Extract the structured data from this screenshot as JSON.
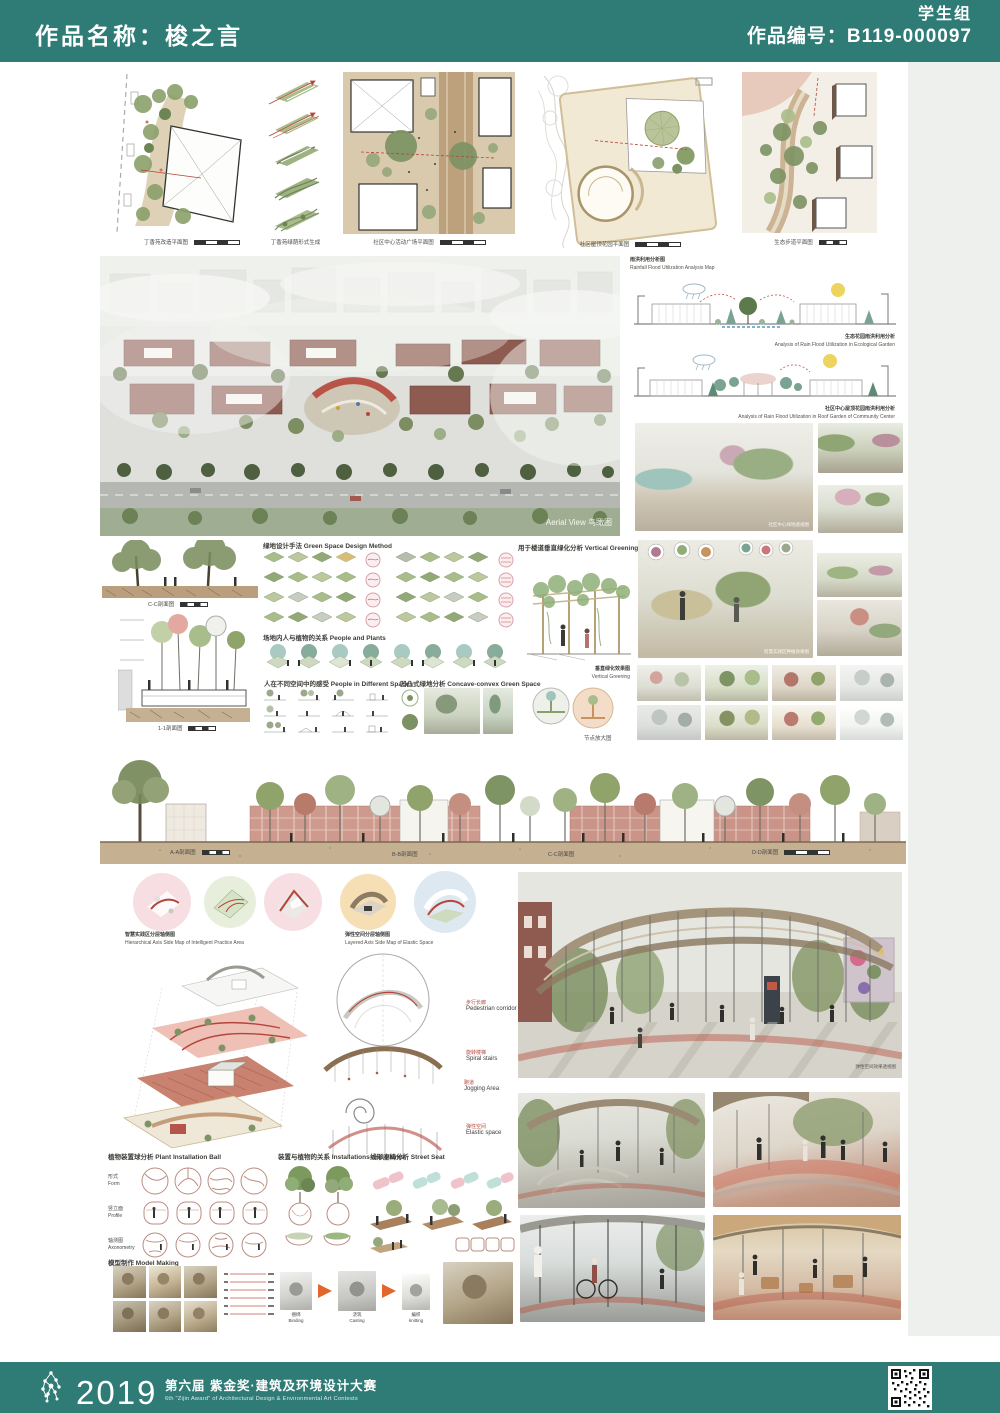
{
  "colors": {
    "teal": "#2f7b76",
    "accent_red": "#b5443a"
  },
  "header": {
    "work_name": "作品名称：梭之言",
    "group": "学生组",
    "work_code": "作品编号：B119-000097"
  },
  "top_row": {
    "captions": [
      "丁香苑改造平面图",
      "丁香苑绿荫形式生成",
      "社区中心活动广场平面图",
      "社区屋顶花园平面图",
      "生态步道平面图"
    ]
  },
  "aerial": {
    "caption": "Aerial View 鸟瞰图"
  },
  "rain": {
    "title_cn": "雨洪利用分析图",
    "title_en": "Rainfall Flood Utilization Analysis Map",
    "items": [
      {
        "cn": "生态花园雨洪利用分析",
        "en": "Analysis of Rain Flood Utilization in Ecological Garden"
      },
      {
        "cn": "社区中心屋顶花园雨洪利用分析",
        "en": "Analysis of Rain Flood Utilization in Roof Garden of Community Center"
      }
    ]
  },
  "renders": {
    "park_caption": "社区中心绿地透视图",
    "garden_caption": "智慧实践区种植效果图"
  },
  "green_method": {
    "title": "绿地设计手法 Green Space Design Method",
    "people_plants": "场地内人与植物的关系 People and Plants",
    "people_spaces": "人在不同空间中的感受 People in Different Spaces",
    "concave": "凹凸式绿地分析 Concave-convex Green Space",
    "vertical_title": "用于楼道垂直绿化分析 Vertical Greening in Tube Apartment",
    "vertical_caption_cn": "垂直绿化效果图",
    "vertical_caption_en": "Vertical Greening",
    "detail_caption": "节点放大图",
    "section_cc": "C-C剖面图",
    "section_11": "1-1剖面图"
  },
  "street": {
    "labels": [
      "A-A剖面图",
      "B-B剖面图",
      "C-C剖面图",
      "D-D剖面图"
    ]
  },
  "elastic": {
    "left_title_cn": "智慧实践区分层轴侧图",
    "left_title_en": "Hierarchical Axis Side Map of Intelligent Practice Area",
    "right_title_cn": "弹性空间分层轴侧图",
    "right_title_en": "Layered Axis Side Map of Elastic Space",
    "annotations": [
      {
        "cn": "步行长廊",
        "en": "Pedestrian corridor"
      },
      {
        "cn": "旋转楼梯",
        "en": "Spiral stairs"
      },
      {
        "cn": "跑道",
        "en": "Jogging Area"
      },
      {
        "cn": "弹性空间",
        "en": "Elastic space"
      }
    ],
    "render_caption": "弹性空间效果透视图"
  },
  "installation": {
    "ball_title": "植物装置球分析 Plant Installation Ball",
    "rows": [
      {
        "cn": "形式",
        "en": "Form"
      },
      {
        "cn": "竖立面",
        "en": "Profile"
      },
      {
        "cn": "轴测图",
        "en": "Axonometry"
      }
    ],
    "plants_title": "装置与植物的关系 Installations and Plants",
    "seat_title": "线形座椅分析 Street Seat"
  },
  "model": {
    "title": "模型制作 Model Making",
    "steps": [
      {
        "cn": "捆绑",
        "en": "Binding"
      },
      {
        "cn": "浇筑",
        "en": "Casting"
      },
      {
        "cn": "编织",
        "en": "knitting"
      }
    ]
  },
  "footer": {
    "year": "2019",
    "award_cn": "第六届 紫金奖·建筑及环境设计大赛",
    "award_en": "6th \"Zijin Award\" of Architectural Design & Environmental Art Contests"
  }
}
